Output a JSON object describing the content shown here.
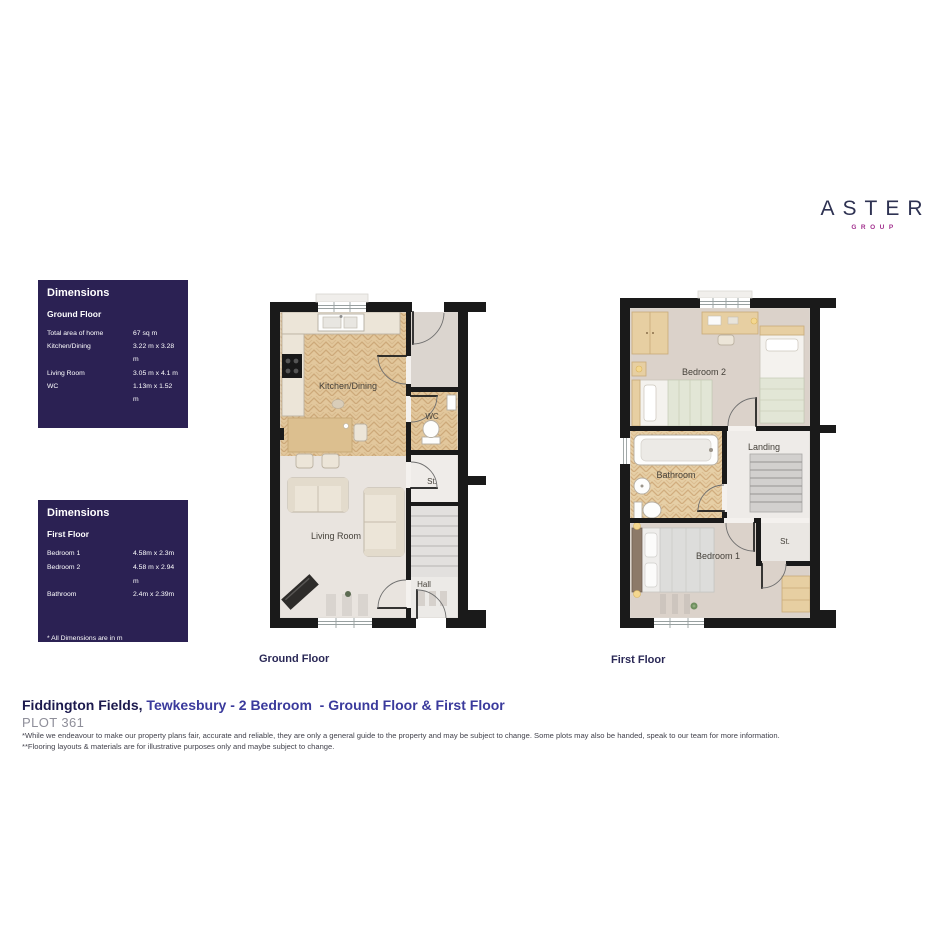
{
  "brand": {
    "name": "ASTER",
    "subtitle": "GROUP"
  },
  "dimensions_boxes": [
    {
      "title": "Dimensions",
      "subtitle": "Ground Floor",
      "rows": [
        {
          "label": "Total area of home",
          "value": "67 sq m"
        },
        {
          "label": "Kitchen/Dining",
          "value": "3.22 m x 3.28 m"
        },
        {
          "label": "Living Room",
          "value": "3.05 m x 4.1 m"
        },
        {
          "label": "WC",
          "value": "1.13m x 1.52 m"
        }
      ],
      "notes": [
        "* All Dimensions are in m",
        "** All measurements are approximate"
      ]
    },
    {
      "title": "Dimensions",
      "subtitle": "First Floor",
      "rows": [
        {
          "label": "Bedroom 1",
          "value": "4.58m x 2.3m"
        },
        {
          "label": "Bedroom 2",
          "value": "4.58 m x 2.94 m"
        },
        {
          "label": "Bathroom",
          "value": "2.4m x 2.39m"
        }
      ],
      "notes": [
        "* All Dimensions are in m",
        "** All measurements are approximate"
      ]
    }
  ],
  "plans": {
    "ground": {
      "caption": "Ground Floor",
      "labels": {
        "kitchen_dining": "Kitchen/Dining",
        "wc": "WC",
        "storage": "St.",
        "living_room": "Living Room",
        "hall": "Hall"
      }
    },
    "first": {
      "caption": "First Floor",
      "labels": {
        "bedroom2": "Bedroom 2",
        "bathroom": "Bathroom",
        "landing": "Landing",
        "storage": "St.",
        "bedroom1": "Bedroom 1"
      }
    }
  },
  "footer": {
    "title_location": "Fiddington Fields,",
    "title_rest": " Tewkesbury - 2 Bedroom  - Ground Floor & First Floor",
    "plot": "PLOT 361",
    "disclaimers": [
      "*While we endeavour to make our property plans fair, accurate and reliable, they are only a general guide to the property and may be subject to change. Some plots may also be handed, speak to our team for more information.",
      "**Flooring layouts & materials are for illustrative purposes only and maybe subject to change."
    ]
  },
  "colors": {
    "brand_navy": "#2e3252",
    "brand_purple": "#a2308e",
    "panel_bg": "#2b2153",
    "title_navy": "#1c1a4e",
    "title_indigo": "#3a3a9c",
    "plot_gray": "#8e8e99",
    "wall_black": "#1a1a1a",
    "wood_floor": "#e2c79c",
    "carpet": "#dbd2ca"
  }
}
